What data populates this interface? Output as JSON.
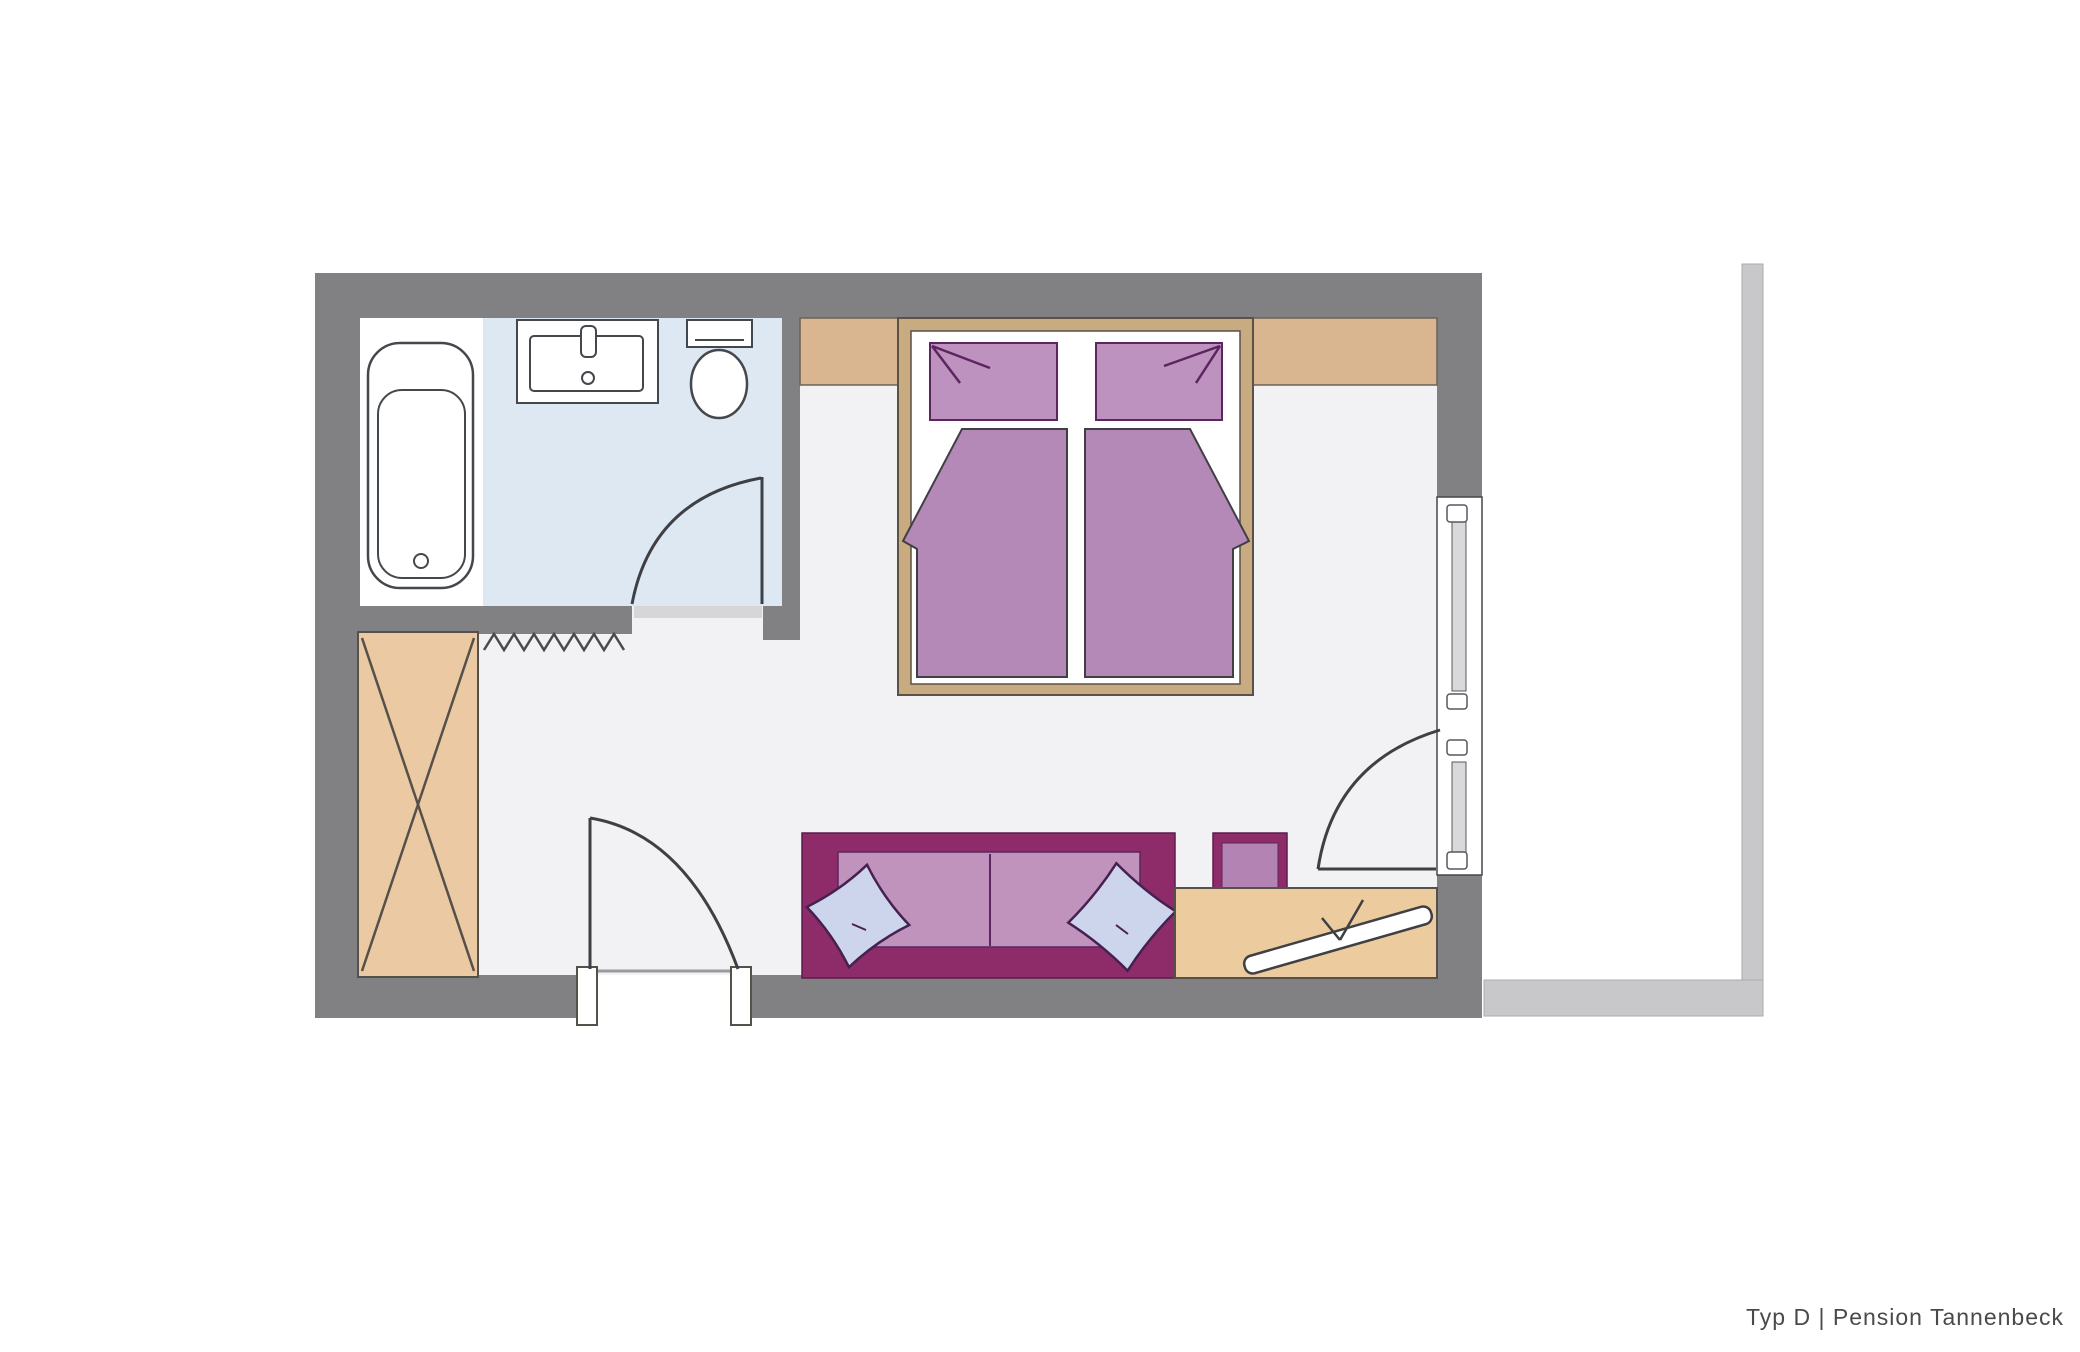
{
  "caption": "Typ D | Pension Tannenbeck",
  "colors": {
    "wall": "#818184",
    "balcony": "#c8c8ca",
    "floor": "#f2f2f4",
    "bathroom_floor": "#dde8f2",
    "wardrobe_wood": "#ebc9a3",
    "headboard_wood": "#d9b690",
    "bed_frame_wood": "#c9ab81",
    "desk_wood": "#eccb9f",
    "bed_textile": "#b488b7",
    "bed_pillow": "#bd92bf",
    "sofa_frame": "#8e2b69",
    "sofa_seat": "#c093bd",
    "cushion": "#cdd5ec",
    "accent_dark": "#5c2560",
    "outline": "#3f3f44",
    "caption_text": "#4a4a4a"
  },
  "symbols": [
    "bathtub",
    "washbasin",
    "toilet",
    "bathroom-door",
    "wardrobe",
    "radiator-zigzag",
    "entry-door",
    "double-bed",
    "bed-pillows",
    "bed-duvets",
    "sofa",
    "sofa-cushions",
    "side-table",
    "desk",
    "bench",
    "window",
    "balcony-door",
    "balcony-rail"
  ]
}
